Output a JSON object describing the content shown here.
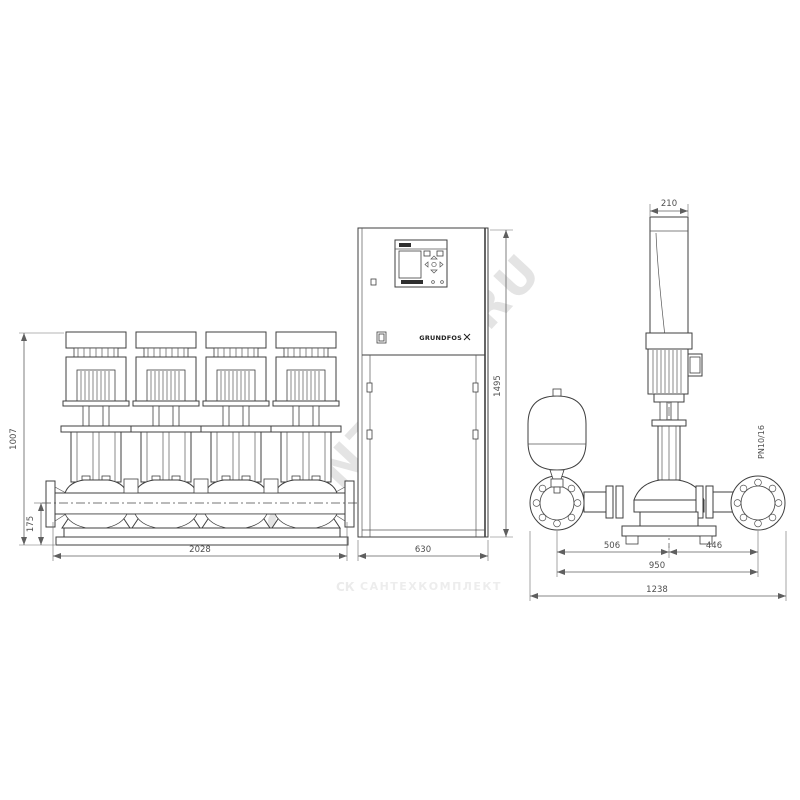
{
  "page": {
    "background": "#ffffff",
    "line_color": "#3f3f3f",
    "dim_color": "#5f5f5f",
    "watermark_color": "#e4e4e4"
  },
  "watermarks": {
    "diagonal": "SANTECH.RU",
    "footer_logo": "СК",
    "footer_text": "САНТЕХКОМПЛЕКТ"
  },
  "front_view": {
    "dims": {
      "total_height": "1007",
      "manifold_height": "175",
      "total_width": "2028"
    }
  },
  "cabinet": {
    "brand": "GRUNDFOS",
    "dims": {
      "width": "630",
      "height": "1495"
    }
  },
  "side_view": {
    "flange_rating": "PN10/16",
    "dims": {
      "top_width": "210",
      "left_offset": "506",
      "right_offset": "446",
      "port_span": "950",
      "total_depth": "1238"
    }
  }
}
